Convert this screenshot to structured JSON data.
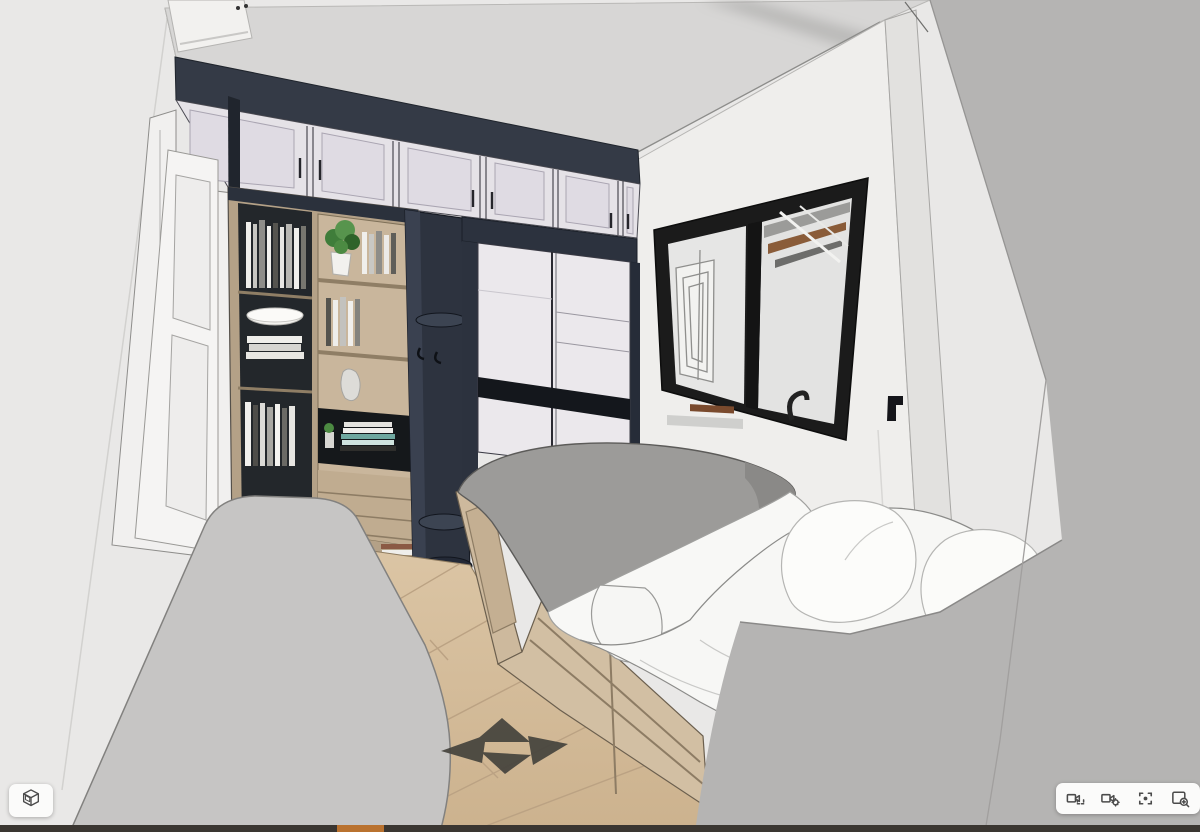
{
  "viewer": {
    "type": "3d-walkthrough-viewer",
    "scene": {
      "description": "SketchUp-style 3D rendering of a small bedroom: white entry door, overhead lavender shaker cabinets with navy trim, wood bookshelf with books and plant, navy corner shelf with hooks, sliding-door wardrobe, black-framed window showing ceiling beams, platform bed with wood drawers, gray duvet and white bedding, light wood plank floor, gray foreground partitions",
      "objects": [
        "entry-door",
        "overhead-cabinets",
        "bookshelf",
        "corner-shelf-unit",
        "sliding-door-wardrobe",
        "window",
        "platform-bed",
        "wood-floor",
        "gray-partition-left",
        "gray-partition-right"
      ]
    },
    "nav_arrows": [
      {
        "direction": "up"
      },
      {
        "direction": "left"
      },
      {
        "direction": "right"
      },
      {
        "direction": "down"
      }
    ]
  },
  "controls": {
    "model_button": {
      "name": "model-views",
      "icon": "cube-3d-icon"
    },
    "camera_toolbar": {
      "buttons": [
        {
          "name": "camera-view",
          "icon": "camera-frame-icon"
        },
        {
          "name": "camera-settings",
          "icon": "camera-gear-icon"
        },
        {
          "name": "recenter-view",
          "icon": "focus-center-icon"
        },
        {
          "name": "zoom-window",
          "icon": "zoom-window-icon"
        }
      ]
    }
  },
  "status_bar": {
    "accent_color": "#b9722f",
    "bar_color": "#3a3631"
  },
  "palette": {
    "canvas_bg": "#e9e8e7",
    "panel_bg": "#fbfbfa",
    "icon": "#4b4b4b",
    "navy": "#2d333f",
    "wood": "#c0ac90",
    "floor_wood": "#d6c0a0",
    "duvet_gray": "#9c9b99",
    "bedding_white": "#f7f7f5",
    "wall_white": "#efeeec",
    "wall_gray": "#b5b4b3",
    "frame_black": "#1b1b1b"
  }
}
